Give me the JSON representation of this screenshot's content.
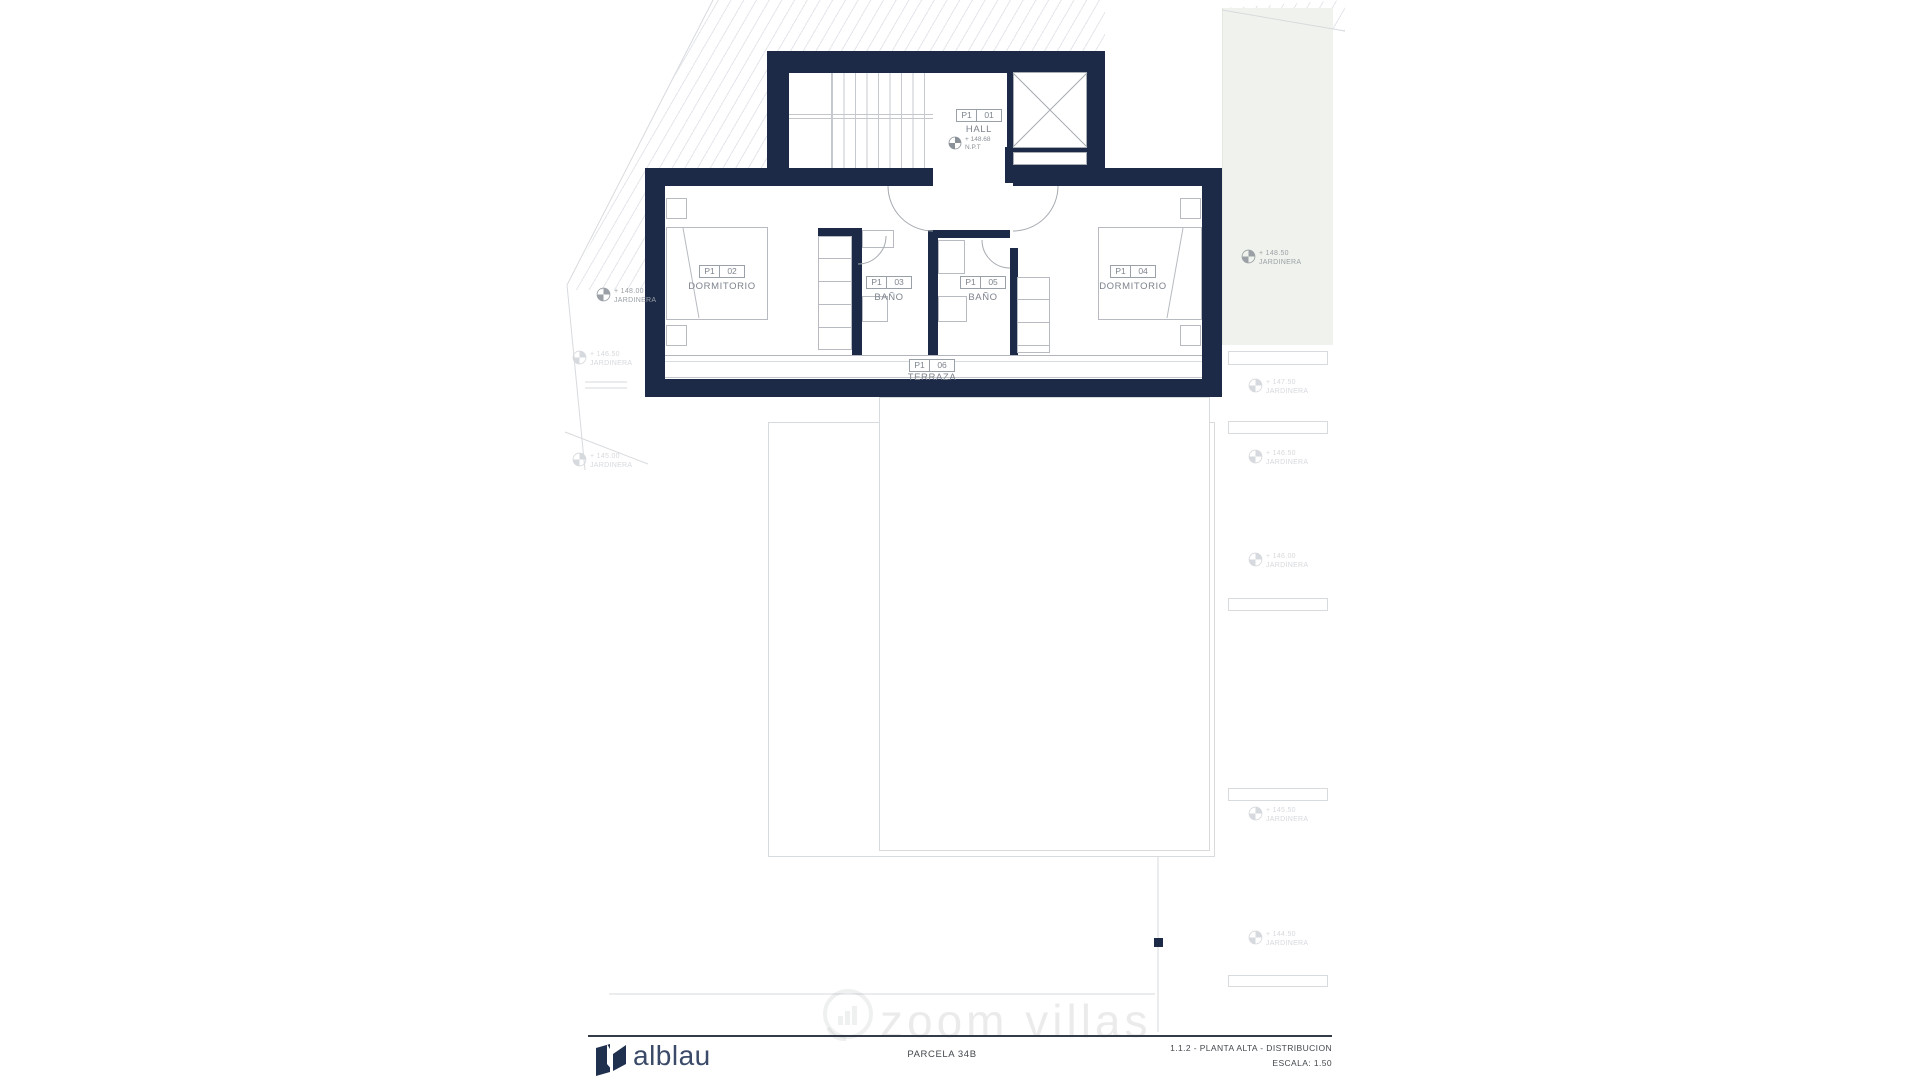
{
  "plan": {
    "rooms": [
      {
        "code": "P1",
        "num": "01",
        "name": "HALL"
      },
      {
        "code": "P1",
        "num": "02",
        "name": "DORMITORIO"
      },
      {
        "code": "P1",
        "num": "03",
        "name": "BAÑO"
      },
      {
        "code": "P1",
        "num": "05",
        "name": "BAÑO"
      },
      {
        "code": "P1",
        "num": "04",
        "name": "DORMITORIO"
      },
      {
        "code": "P1",
        "num": "06",
        "name": "TERRAZA"
      }
    ],
    "hall_level": {
      "value": "+ 148.68",
      "datum": "N.P.T"
    },
    "markers": [
      {
        "value": "+ 148.00",
        "name": "JARDINERA"
      },
      {
        "value": "+ 148.50",
        "name": "JARDINERA"
      },
      {
        "value": "+ 146.50",
        "name": "JARDINERA"
      },
      {
        "value": "+ 145.00",
        "name": "JARDINERA"
      },
      {
        "value": "+ 147.50",
        "name": "JARDINERA"
      },
      {
        "value": "+ 146.50",
        "name": "JARDINERA"
      },
      {
        "value": "+ 146.00",
        "name": "JARDINERA"
      },
      {
        "value": "+ 145.50",
        "name": "JARDINERA"
      },
      {
        "value": "+ 144.50",
        "name": "JARDINERA"
      }
    ]
  },
  "footer": {
    "brand": "alblau",
    "parcel": "PARCELA 34B",
    "sheet": "1.1.2 - PLANTA ALTA -  DISTRIBUCION",
    "scale": "ESCALA: 1.50"
  },
  "watermark": "zoom villas",
  "colors": {
    "wall": "#1c2a47",
    "green_band": "#f0f3ed"
  }
}
